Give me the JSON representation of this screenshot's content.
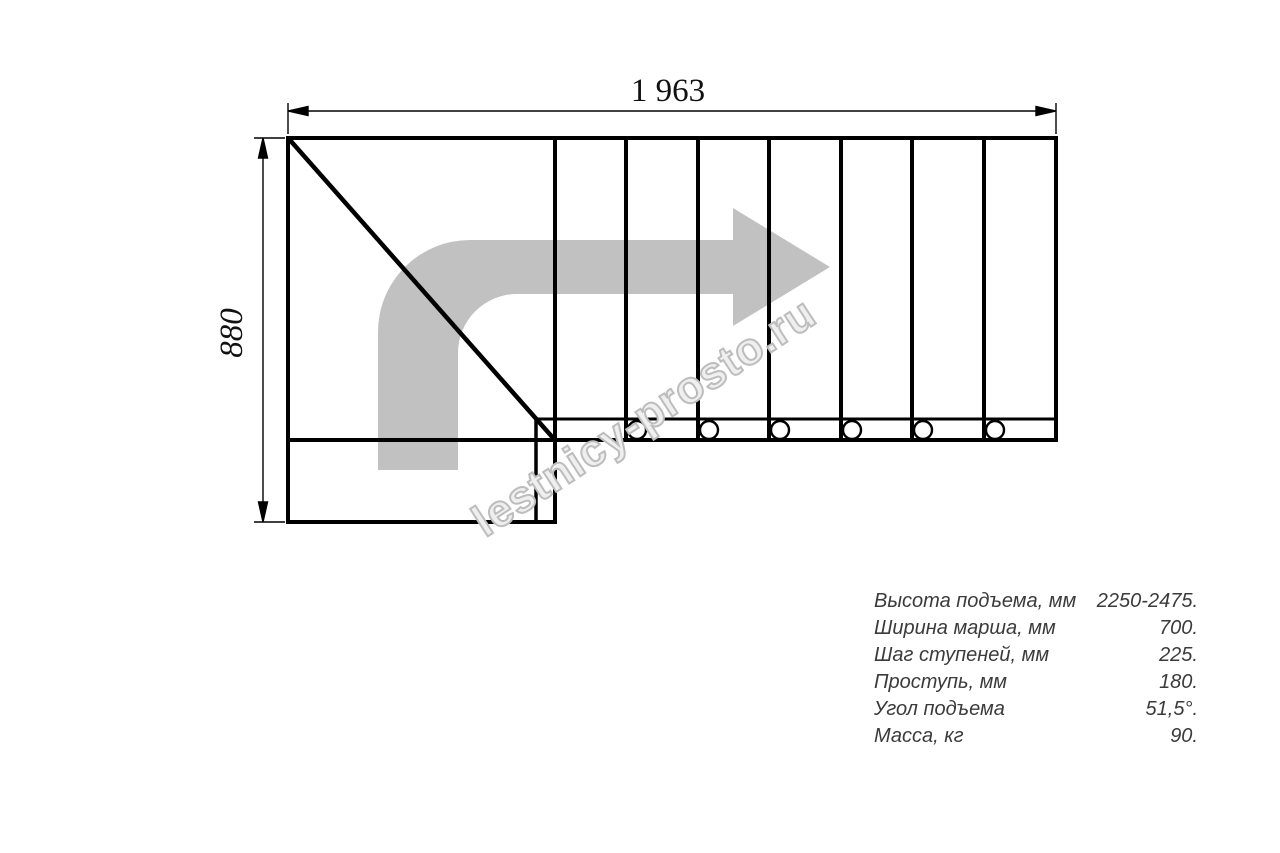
{
  "page": {
    "background": "#ffffff"
  },
  "drawing": {
    "width_dimension_label": "1 963",
    "height_dimension_label": "880",
    "line_color": "#000000",
    "direction_arrow_color": "#c1c1c1",
    "tread_divider_count": 7,
    "mount_hole_count": 6
  },
  "watermark": {
    "text": "lestnicy-prosto.ru",
    "color": "#bdbdbd"
  },
  "specs": {
    "rows": [
      {
        "label": "Высота подъема, мм",
        "value": "2250-2475."
      },
      {
        "label": "Ширина марша, мм",
        "value": "700."
      },
      {
        "label": "Шаг ступеней, мм",
        "value": "225."
      },
      {
        "label": "Проступь, мм",
        "value": "180."
      },
      {
        "label": "Угол подъема",
        "value": "51,5°."
      },
      {
        "label": "Масса, кг",
        "value": "90."
      }
    ]
  }
}
